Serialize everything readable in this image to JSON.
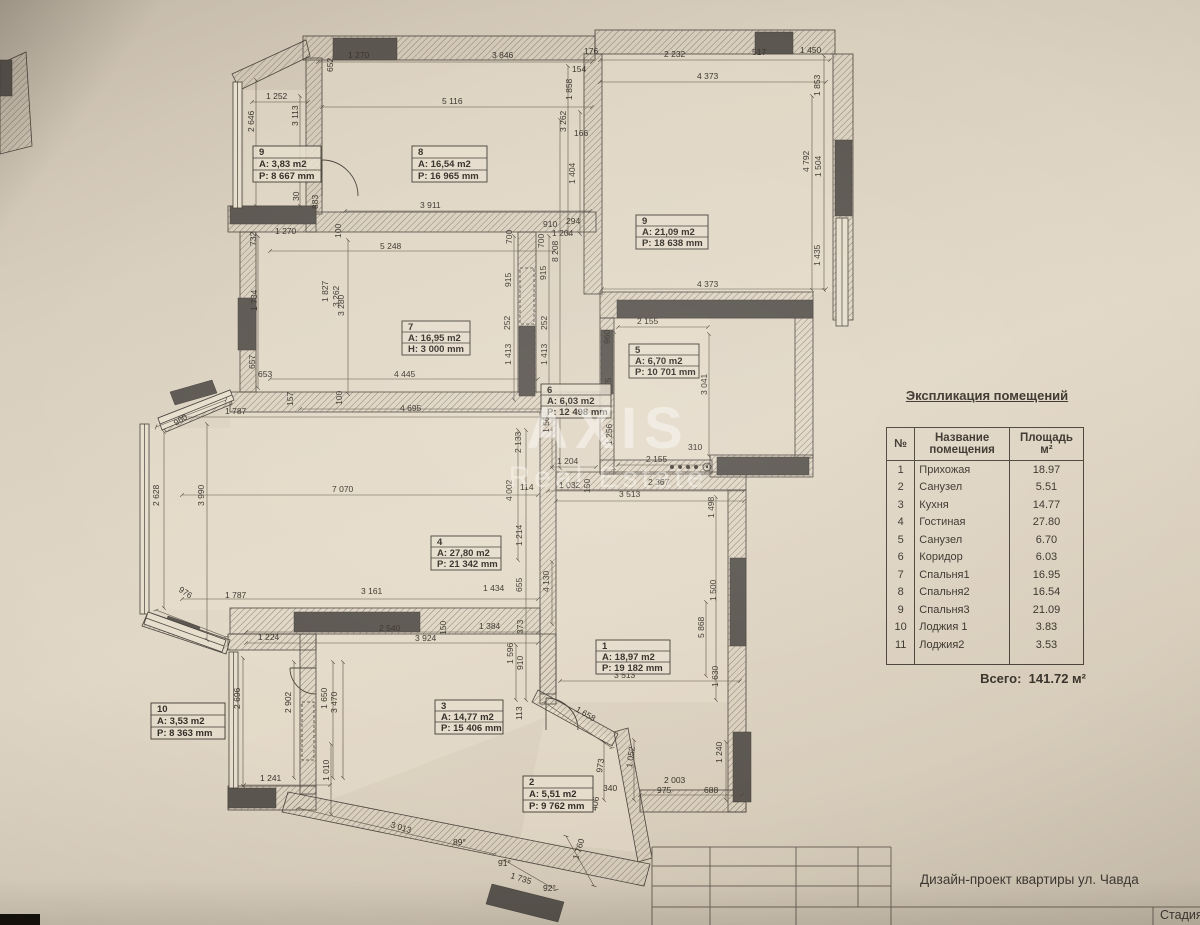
{
  "watermark": {
    "line1": "AXIS",
    "line2": "Real Estate"
  },
  "legend": {
    "title": "Экспликация помещений",
    "col_num": "№",
    "col_name_1": "Название",
    "col_name_2": "помещения",
    "col_area_1": "Площадь",
    "col_area_2": "м²",
    "rows": [
      {
        "num": "1",
        "name": "Прихожая",
        "area": "18.97"
      },
      {
        "num": "2",
        "name": "Санузел",
        "area": "5.51"
      },
      {
        "num": "3",
        "name": "Кухня",
        "area": "14.77"
      },
      {
        "num": "4",
        "name": "Гостиная",
        "area": "27.80"
      },
      {
        "num": "5",
        "name": "Санузел",
        "area": "6.70"
      },
      {
        "num": "6",
        "name": "Коридор",
        "area": "6.03"
      },
      {
        "num": "7",
        "name": "Спальня1",
        "area": "16.95"
      },
      {
        "num": "8",
        "name": "Спальня2",
        "area": "16.54"
      },
      {
        "num": "9",
        "name": "Спальня3",
        "area": "21.09"
      },
      {
        "num": "10",
        "name": "Лоджия 1",
        "area": "3.83"
      },
      {
        "num": "11",
        "name": "Лоджия2",
        "area": "3.53"
      }
    ],
    "total_label": "Всего:",
    "total_value": "141.72 м²"
  },
  "title_block": {
    "project": "Дизайн-проект квартиры ул. Чавда",
    "stage": "Стадия"
  },
  "rooms": [
    {
      "num": "1",
      "area": "A: 18,97 m2",
      "perim": "P: 19 182 mm"
    },
    {
      "num": "2",
      "area": "A: 5,51 m2",
      "perim": "P: 9 762 mm"
    },
    {
      "num": "3",
      "area": "A: 14,77 m2",
      "perim": "P: 15 406 mm"
    },
    {
      "num": "4",
      "area": "A: 27,80 m2",
      "perim": "P: 21 342 mm"
    },
    {
      "num": "5",
      "area": "A: 6,70 m2",
      "perim": "P: 10 701 mm"
    },
    {
      "num": "6",
      "area": "A: 6,03 m2",
      "perim": "P: 12 498 mm"
    },
    {
      "num": "7",
      "area": "A: 16,95 m2",
      "perim": "H: 3 000 mm"
    },
    {
      "num": "8",
      "area": "A: 16,54 m2",
      "perim": "P: 16 965 mm"
    },
    {
      "num": "9",
      "area": "A: 21,09 m2",
      "perim": "P: 18 638 mm"
    },
    {
      "num": "9",
      "area": "A: 3,83 m2",
      "perim": "P: 8 667 mm"
    },
    {
      "num": "10",
      "area": "A: 3,53 m2",
      "perim": "P: 8 363 mm"
    }
  ],
  "dims": [
    "652",
    "1 270",
    "3 846",
    "5 116",
    "176",
    "154",
    "2 232",
    "517",
    "1 450",
    "4 373",
    "1 252",
    "2 646",
    "3 113",
    "1 858",
    "3 262",
    "166",
    "1 404",
    "910",
    "294",
    "1 204",
    "700",
    "8 208",
    "915",
    "1 853",
    "4 792",
    "1 504",
    "1 435",
    "4 373",
    "30",
    "883",
    "3 911",
    "732",
    "1 270",
    "100",
    "5 248",
    "700",
    "915",
    "252",
    "1 413",
    "252",
    "1 413",
    "1 827",
    "3 262",
    "1 734",
    "3 280",
    "657",
    "653",
    "4 445",
    "157",
    "100",
    "4 695",
    "1 787",
    "960",
    "2 628",
    "3 990",
    "976",
    "1 787",
    "7 070",
    "3 161",
    "1 434",
    "2 540",
    "3 924",
    "150",
    "1 384",
    "1 224",
    "2 696",
    "2 902",
    "1 650",
    "3 470",
    "1 596",
    "1 241",
    "1 010",
    "3 013",
    "89°",
    "91°",
    "1 735",
    "92°",
    "1 760",
    "973",
    "1 052",
    "340",
    "406",
    "2 003",
    "975",
    "688",
    "1 240",
    "113",
    "2 155",
    "960",
    "975",
    "1 256",
    "3 041",
    "310",
    "2 155",
    "2 367",
    "3 513",
    "1 032",
    "150",
    "1 566",
    "1 204",
    "114",
    "2 133",
    "4 002",
    "1 214",
    "655",
    "373",
    "910",
    "4 130",
    "1 498",
    "1 500",
    "5 868",
    "1 630",
    "1 658",
    "3 513"
  ]
}
